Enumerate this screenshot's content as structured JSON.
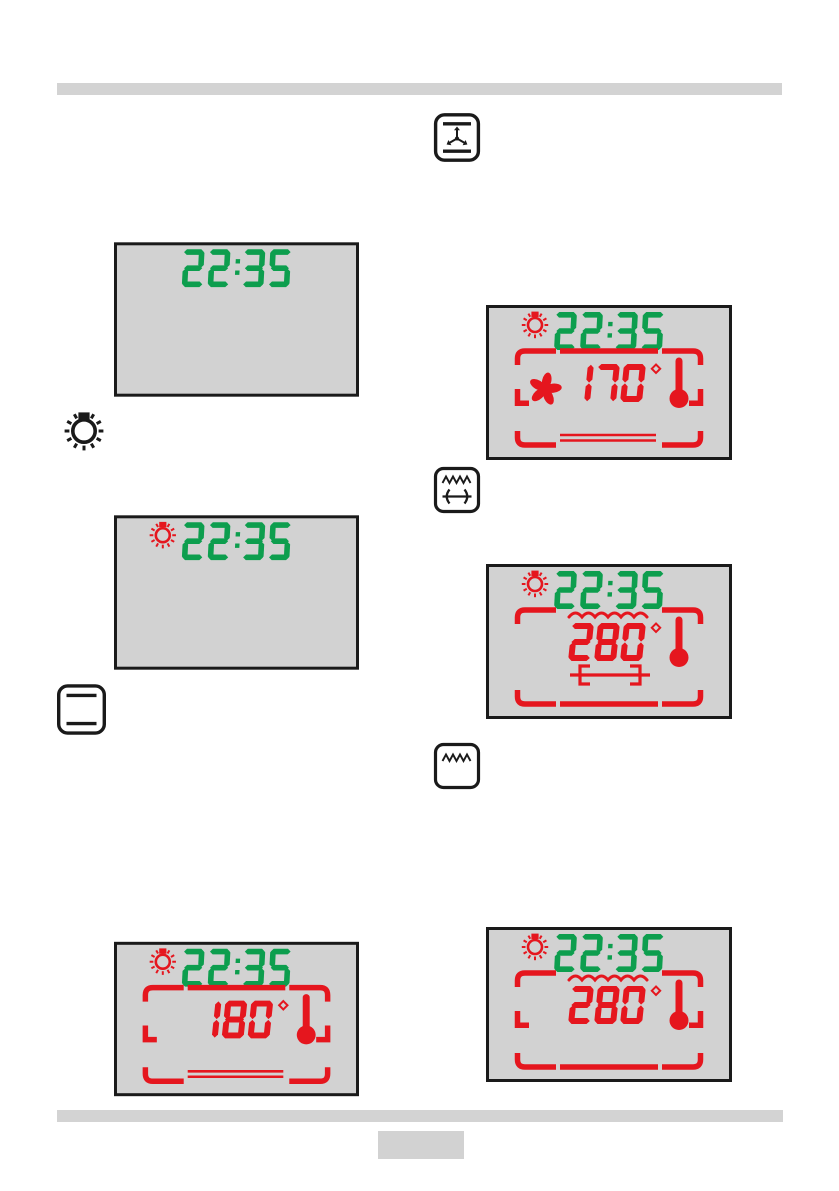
{
  "colors": {
    "lcd_green": "#0d9e4e",
    "lcd_red": "#e5161e",
    "lcd_bg": "#d2d2d2",
    "lcd_border": "#1a1a1a",
    "icon_black": "#1a1a1a",
    "bar_gray": "#d3d3d3"
  },
  "function_icons": [
    {
      "name": "fan-with-top-bottom-heat-icon"
    },
    {
      "name": "oven-light-icon"
    },
    {
      "name": "top-bottom-heat-icon"
    },
    {
      "name": "grill-with-rotisserie-icon"
    },
    {
      "name": "grill-icon"
    }
  ],
  "displays": [
    {
      "id": "clock-only",
      "clock": "22:35",
      "lamp_icon": false,
      "temperature": null,
      "degree_symbol": false,
      "thermometer_icon": false,
      "fan_icon": false,
      "grill_element_wave": false,
      "rotisserie_icon": false,
      "top_frame": "none",
      "side_corners": false,
      "bottom_frame": "none"
    },
    {
      "id": "clock-with-lamp",
      "clock": "22:35",
      "lamp_icon": true,
      "temperature": null,
      "degree_symbol": false,
      "thermometer_icon": false,
      "fan_icon": false,
      "grill_element_wave": false,
      "rotisserie_icon": false,
      "top_frame": "none",
      "side_corners": false,
      "bottom_frame": "none"
    },
    {
      "id": "conventional-heating-180",
      "clock": "22:35",
      "lamp_icon": true,
      "temperature": "180",
      "degree_symbol": true,
      "thermometer_icon": true,
      "fan_icon": false,
      "grill_element_wave": false,
      "rotisserie_icon": false,
      "top_frame": "full",
      "side_corners": true,
      "bottom_frame": "double-lines"
    },
    {
      "id": "fan-heating-170",
      "clock": "22:35",
      "lamp_icon": true,
      "temperature": "170",
      "degree_symbol": true,
      "thermometer_icon": true,
      "fan_icon": true,
      "grill_element_wave": false,
      "rotisserie_icon": false,
      "top_frame": "full",
      "side_corners": true,
      "bottom_frame": "double-lines"
    },
    {
      "id": "grill-rotisserie-280",
      "clock": "22:35",
      "lamp_icon": true,
      "temperature": "280",
      "degree_symbol": true,
      "thermometer_icon": true,
      "fan_icon": false,
      "grill_element_wave": true,
      "rotisserie_icon": true,
      "top_frame": "corners",
      "side_corners": false,
      "bottom_frame": "full"
    },
    {
      "id": "grill-280",
      "clock": "22:35",
      "lamp_icon": true,
      "temperature": "280",
      "degree_symbol": true,
      "thermometer_icon": true,
      "fan_icon": false,
      "grill_element_wave": true,
      "rotisserie_icon": false,
      "top_frame": "corners",
      "side_corners": true,
      "bottom_frame": "full"
    }
  ],
  "page_number_box": ""
}
